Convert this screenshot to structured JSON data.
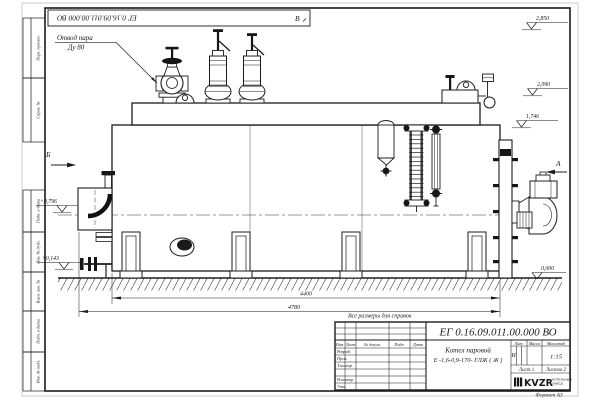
{
  "document": {
    "designation": "ЕГ 0.16.09.011.00.000  ВО",
    "note": "Все размеры для справок",
    "format": "Формат А3"
  },
  "product": {
    "name": "Котел паровой",
    "model": "Е -1,6-0,9-170- ГЛЖ ( Ж )"
  },
  "title_block": {
    "izm": "Изм.",
    "list_col": "Лист",
    "doc_col": "№ докум.",
    "podp_col": "Подп.",
    "data_col": "Дата",
    "razrab": "Разраб.",
    "prov": "Пров.",
    "tkontr": "Т.контр.",
    "nkontr": "Н.контр.",
    "utv": "Утв.",
    "lit_header": "Лит.",
    "mass_header": "Масса",
    "scale_header": "Масштаб",
    "lit_value": "И",
    "scale_value": "1:15",
    "sheet": "Лист 1",
    "sheets": "Листов 2",
    "logo_text": "KVZR",
    "company_line1": "КОТЕЛЬНЫЙ",
    "company_line2": "ЗАВОД"
  },
  "margin_columns": {
    "perv_primen": "Перв. примен.",
    "sprav_no": "Справ. №",
    "podp_data_1": "Подп. и дата",
    "inv_dubl": "Инв. № дубл.",
    "vzam_inv": "Взам. инв. №",
    "podp_data_2": "Подп. и дата",
    "inv_podl": "Инв. № подл."
  },
  "callouts": {
    "steam_line1": "Отвод пара",
    "steam_line2": "Ду 80"
  },
  "view_markers": {
    "a": "А",
    "b": "Б",
    "v": "В"
  },
  "elevations": {
    "valve_top": "2,850",
    "safety_top": "2,090",
    "drum_top": "1,746",
    "left_upper": "+0,796",
    "left_lower": "+0,143",
    "ground": "0,000"
  },
  "dimensions": {
    "body_length": "4400",
    "overall_length": "4780"
  }
}
